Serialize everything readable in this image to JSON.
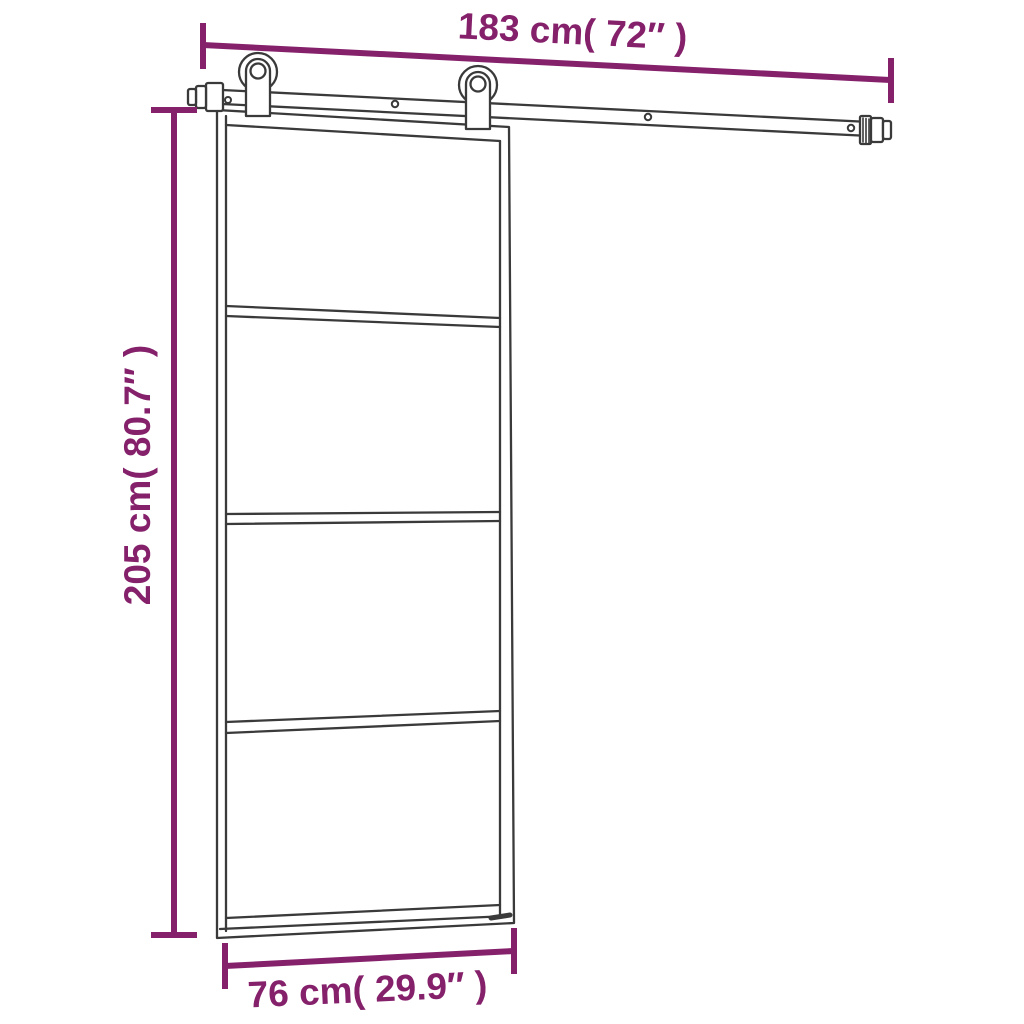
{
  "page": {
    "background": "#ffffff",
    "description": "sliding-door-dimension-diagram"
  },
  "diagram": {
    "type": "product-dimension-diagram",
    "subject": "sliding glass door with top track hardware kit",
    "door_panel_count": 4,
    "roller_count": 2,
    "colors": {
      "dimension": "#85216b",
      "line": "#3a3a3a",
      "fill": "#ffffff"
    },
    "dimensions": {
      "track_length": {
        "label": "183 cm( 72″ )",
        "orientation": "horizontal-top"
      },
      "door_height": {
        "label": "205 cm( 80.7″ )",
        "orientation": "vertical-left"
      },
      "door_width": {
        "label": "76 cm( 29.9″ )",
        "orientation": "horizontal-bottom"
      }
    }
  }
}
